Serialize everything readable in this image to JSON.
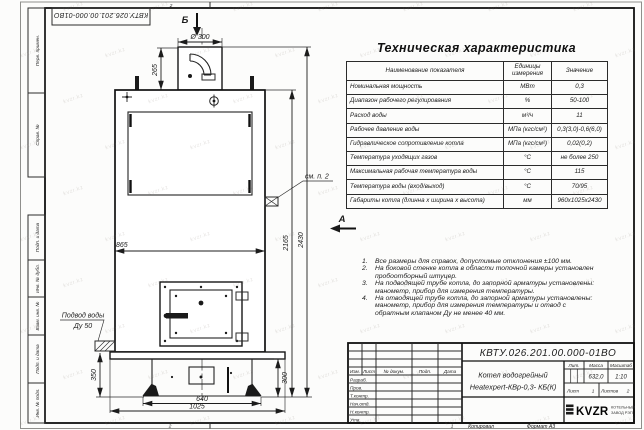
{
  "sheet": {
    "doc_number_top": "КВТУ.026.201.00.000-01ВО",
    "side_labels": [
      "Перв. примен.",
      "Справ. №",
      "Подп. и дата",
      "Инв. № дубл.",
      "Взам. инв. №",
      "Подп. и дата",
      "Инв. № подл."
    ],
    "copied_label": "Копировал",
    "format_label": "Формат А3",
    "zone_left": "2",
    "zone_right": "1"
  },
  "spec_table": {
    "title": "Техническая характеристика",
    "headers": [
      "Наименование показателя",
      "Единицы измерения",
      "Значение"
    ],
    "rows": [
      [
        "Номинальная мощность",
        "МВт",
        "0,3"
      ],
      [
        "Диапазон рабочего регулирования",
        "%",
        "50-100"
      ],
      [
        "Расход воды",
        "м³/ч",
        "11"
      ],
      [
        "Рабочее давление воды",
        "МПа (кгс/см²)",
        "0,3(3,0)-0,6(6,0)"
      ],
      [
        "Гидравлическое сопротивление котла",
        "МПа (кгс/см²)",
        "0,02(0,2)"
      ],
      [
        "Температура уходящих газов",
        "°С",
        "не более 250"
      ],
      [
        "Максимальная рабочая температура воды",
        "°С",
        "115"
      ],
      [
        "Температура воды (вход/выход)",
        "°С",
        "70/95"
      ],
      [
        "Габариты котла (длинна х ширина х высота)",
        "мм",
        "960х1025х2430"
      ]
    ]
  },
  "notes": [
    {
      "num": "1.",
      "text": "Все размеры для справок, допустимые отклонения ±100 мм."
    },
    {
      "num": "2.",
      "text": "На боковой стенке котла в области топочной камеры установлен пробоотборный штуцер."
    },
    {
      "num": "3.",
      "text": "На подводящей трубе котла, до запорной арматуры установлены: манометр, прибор для измерения температуры."
    },
    {
      "num": "4.",
      "text": "На отводящей трубе котла, до запорной арматуры установлены: манометр, прибор для измерения температуры и отвод с обратным клапаном Ду не менее 40 мм."
    }
  ],
  "drawing": {
    "views": {
      "top_view": "Б",
      "side_view": "А"
    },
    "dims": {
      "chimney_diameter": "Ø 300",
      "chimney_height": "265",
      "body_width": "865",
      "body_height": "2165",
      "total_height": "2430",
      "inlet_height": "350",
      "base_height": "300",
      "base_width": "640",
      "total_depth": "1025"
    },
    "callout_see_note": "см. п. 2",
    "water_inlet_line1": "Подвод воды",
    "water_inlet_line2": "Ду 50"
  },
  "title_block": {
    "doc_number": "КВТУ.026.201.00.000-01ВО",
    "product_line1": "Котел водогрейный",
    "product_line2": "Heatexpert-КВр-0,3- КБ(К)",
    "change_cols": [
      "Изм.",
      "Лист",
      "№ докум.",
      "Подп.",
      "Дата"
    ],
    "sig_labels": [
      "Разраб.",
      "Пров.",
      "Т.контр.",
      "Нач.отд.",
      "Н.контр.",
      "Утв."
    ],
    "lit_label": "Лит.",
    "mass_label": "Масса",
    "scale_label": "Масштаб",
    "mass_value": "632,0",
    "scale_value": "1:10",
    "sheet_label": "Лист",
    "sheet_value": "1",
    "sheets_label": "Листов",
    "sheets_value": "2",
    "logo_text": "KVZR",
    "logo_caption1": "КОТЕЛЬНЫЙ",
    "logo_caption2": "ЗАВОД РЭП"
  },
  "watermark_text": "kvzr.kz",
  "colors": {
    "paper": "#fcfcfb",
    "line": "#1c1c1c",
    "logo": "#0a0a0a"
  }
}
